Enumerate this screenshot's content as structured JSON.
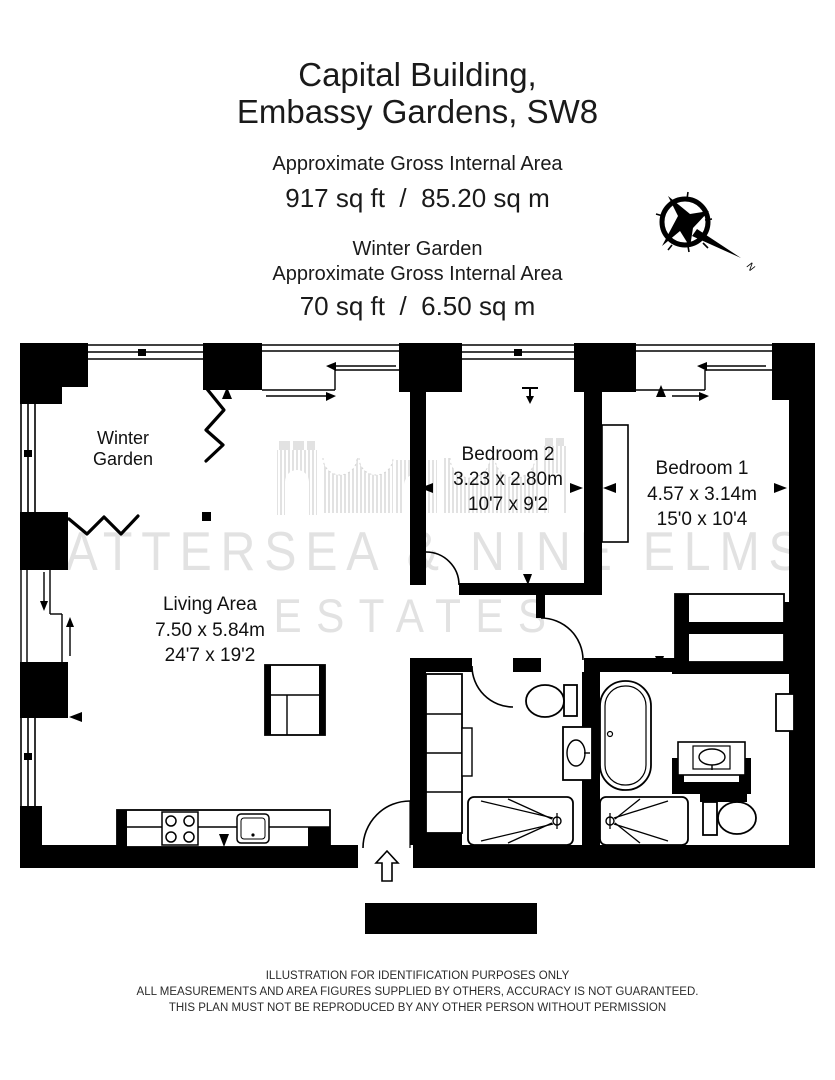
{
  "header": {
    "title_line1": "Capital Building,",
    "title_line2": "Embassy Gardens, SW8",
    "gia_label": "Approximate Gross Internal Area",
    "gia_value": "917 sq ft  /  85.20 sq m",
    "wg_title": "Winter Garden",
    "wg_gia_label": "Approximate Gross Internal Area",
    "wg_gia_value": "70 sq ft  /  6.50 sq m"
  },
  "compass": {
    "north": "N"
  },
  "plan": {
    "rooms": {
      "winter_garden": {
        "line1": "Winter",
        "line2": "Garden"
      },
      "living": {
        "name": "Living Area",
        "dim_m": "7.50 x 5.84m",
        "dim_ft": "24'7 x 19'2"
      },
      "bedroom2": {
        "name": "Bedroom 2",
        "dim_m": "3.23 x 2.80m",
        "dim_ft": "10'7 x 9'2"
      },
      "bedroom1": {
        "name": "Bedroom 1",
        "dim_m": "4.57 x 3.14m",
        "dim_ft": "15'0 x 10'4"
      }
    }
  },
  "watermark": {
    "line1": "BATTERSEA & NINE ELMS",
    "line2": "ESTATES"
  },
  "footer": {
    "line1": "ILLUSTRATION FOR IDENTIFICATION PURPOSES ONLY",
    "line2": "ALL MEASUREMENTS AND AREA FIGURES SUPPLIED BY OTHERS, ACCURACY IS NOT GUARANTEED.",
    "line3": "THIS PLAN MUST NOT BE REPRODUCED BY ANY OTHER PERSON WITHOUT PERMISSION"
  },
  "colors": {
    "ink": "#000000",
    "watermark": "#e2e2e2"
  }
}
